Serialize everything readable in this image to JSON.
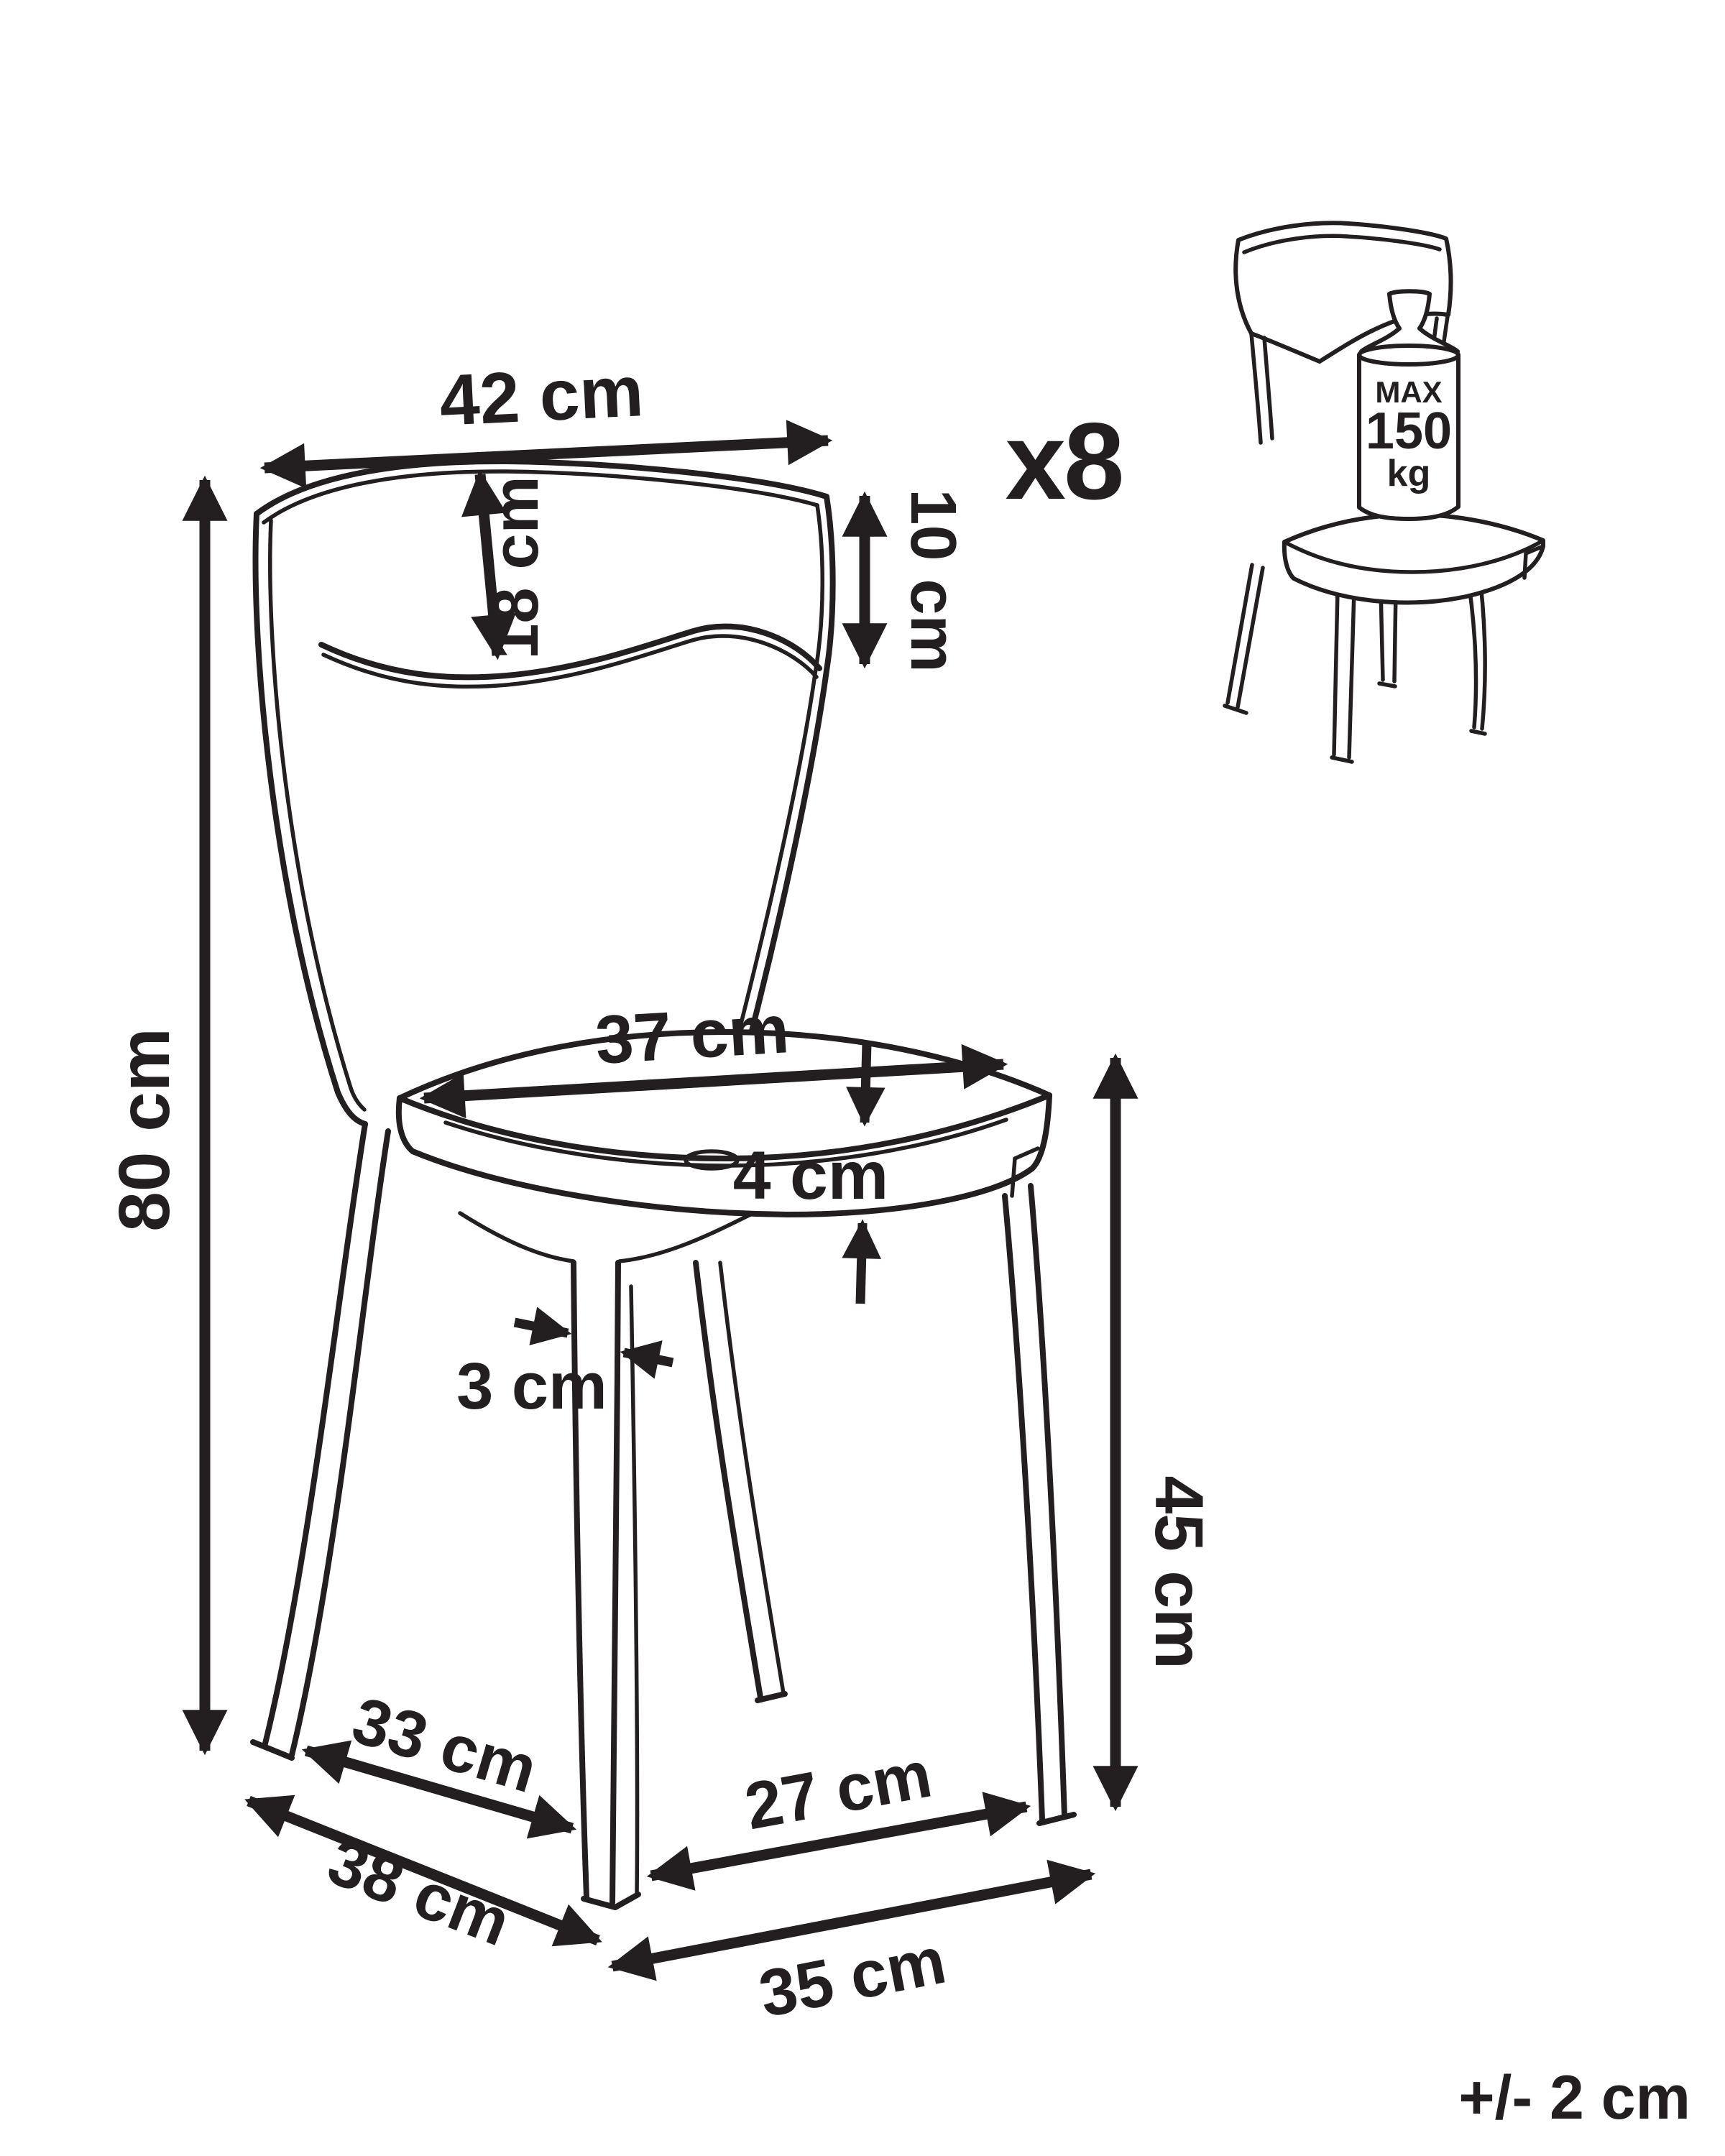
{
  "diagram": {
    "background": "#ffffff",
    "line_color": "#231f20",
    "quantity": "x8",
    "tolerance": "+/- 2 cm",
    "weight_limit": {
      "max": "MAX",
      "value": "150",
      "unit": "kg"
    },
    "dimensions": {
      "backrest_width": "42 cm",
      "backrest_center_height": "18 cm",
      "backrest_side_height": "10 cm",
      "overall_height": "80 cm",
      "seat_width": "37 cm",
      "seat_thickness": "4 cm",
      "leg_thickness": "3 cm",
      "seat_height": "45 cm",
      "floor_back_to_front": "33 cm",
      "floor_front_width": "27 cm",
      "floor_side_depth": "38 cm",
      "floor_front_depth": "35 cm"
    }
  }
}
